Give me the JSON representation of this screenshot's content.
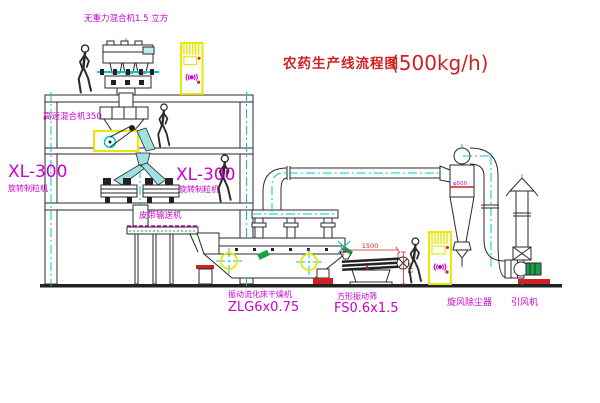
{
  "title": {
    "name": "农药生产线流程图",
    "capacity": "(500kg/h)"
  },
  "equipment": {
    "gravity_mixer": {
      "label": "无重力混合机1.5 立方"
    },
    "high_speed_mixer": {
      "label": "高速混合机350"
    },
    "granulator_left": {
      "model": "XL-300",
      "label": "旋转制粒机"
    },
    "granulator_right": {
      "model": "XL-300",
      "label": "旋转制粒机"
    },
    "belt_conveyor": {
      "label": "皮带输送机"
    },
    "fluid_bed_dryer": {
      "label": "振动流化床干燥机",
      "model": "ZLG6x0.75"
    },
    "square_sieve": {
      "label": "方形振动筛",
      "model": "FS0.6x1.5"
    },
    "cyclone": {
      "label": "旋风除尘器",
      "diameter_note": "φ500"
    },
    "induced_draft_fan": {
      "label": "引风机"
    }
  },
  "dimensions": {
    "sieve_width": "1500",
    "sieve_height": "341"
  },
  "colors": {
    "drawing_line": "#2a2a2a",
    "centerline_cyan": "#00c8c8",
    "label_magenta": "#cc00cc",
    "title_red": "#cc2222",
    "highlight_yellow": "#e8e800",
    "accent_red": "#cc2222",
    "accent_green": "#18a048"
  }
}
